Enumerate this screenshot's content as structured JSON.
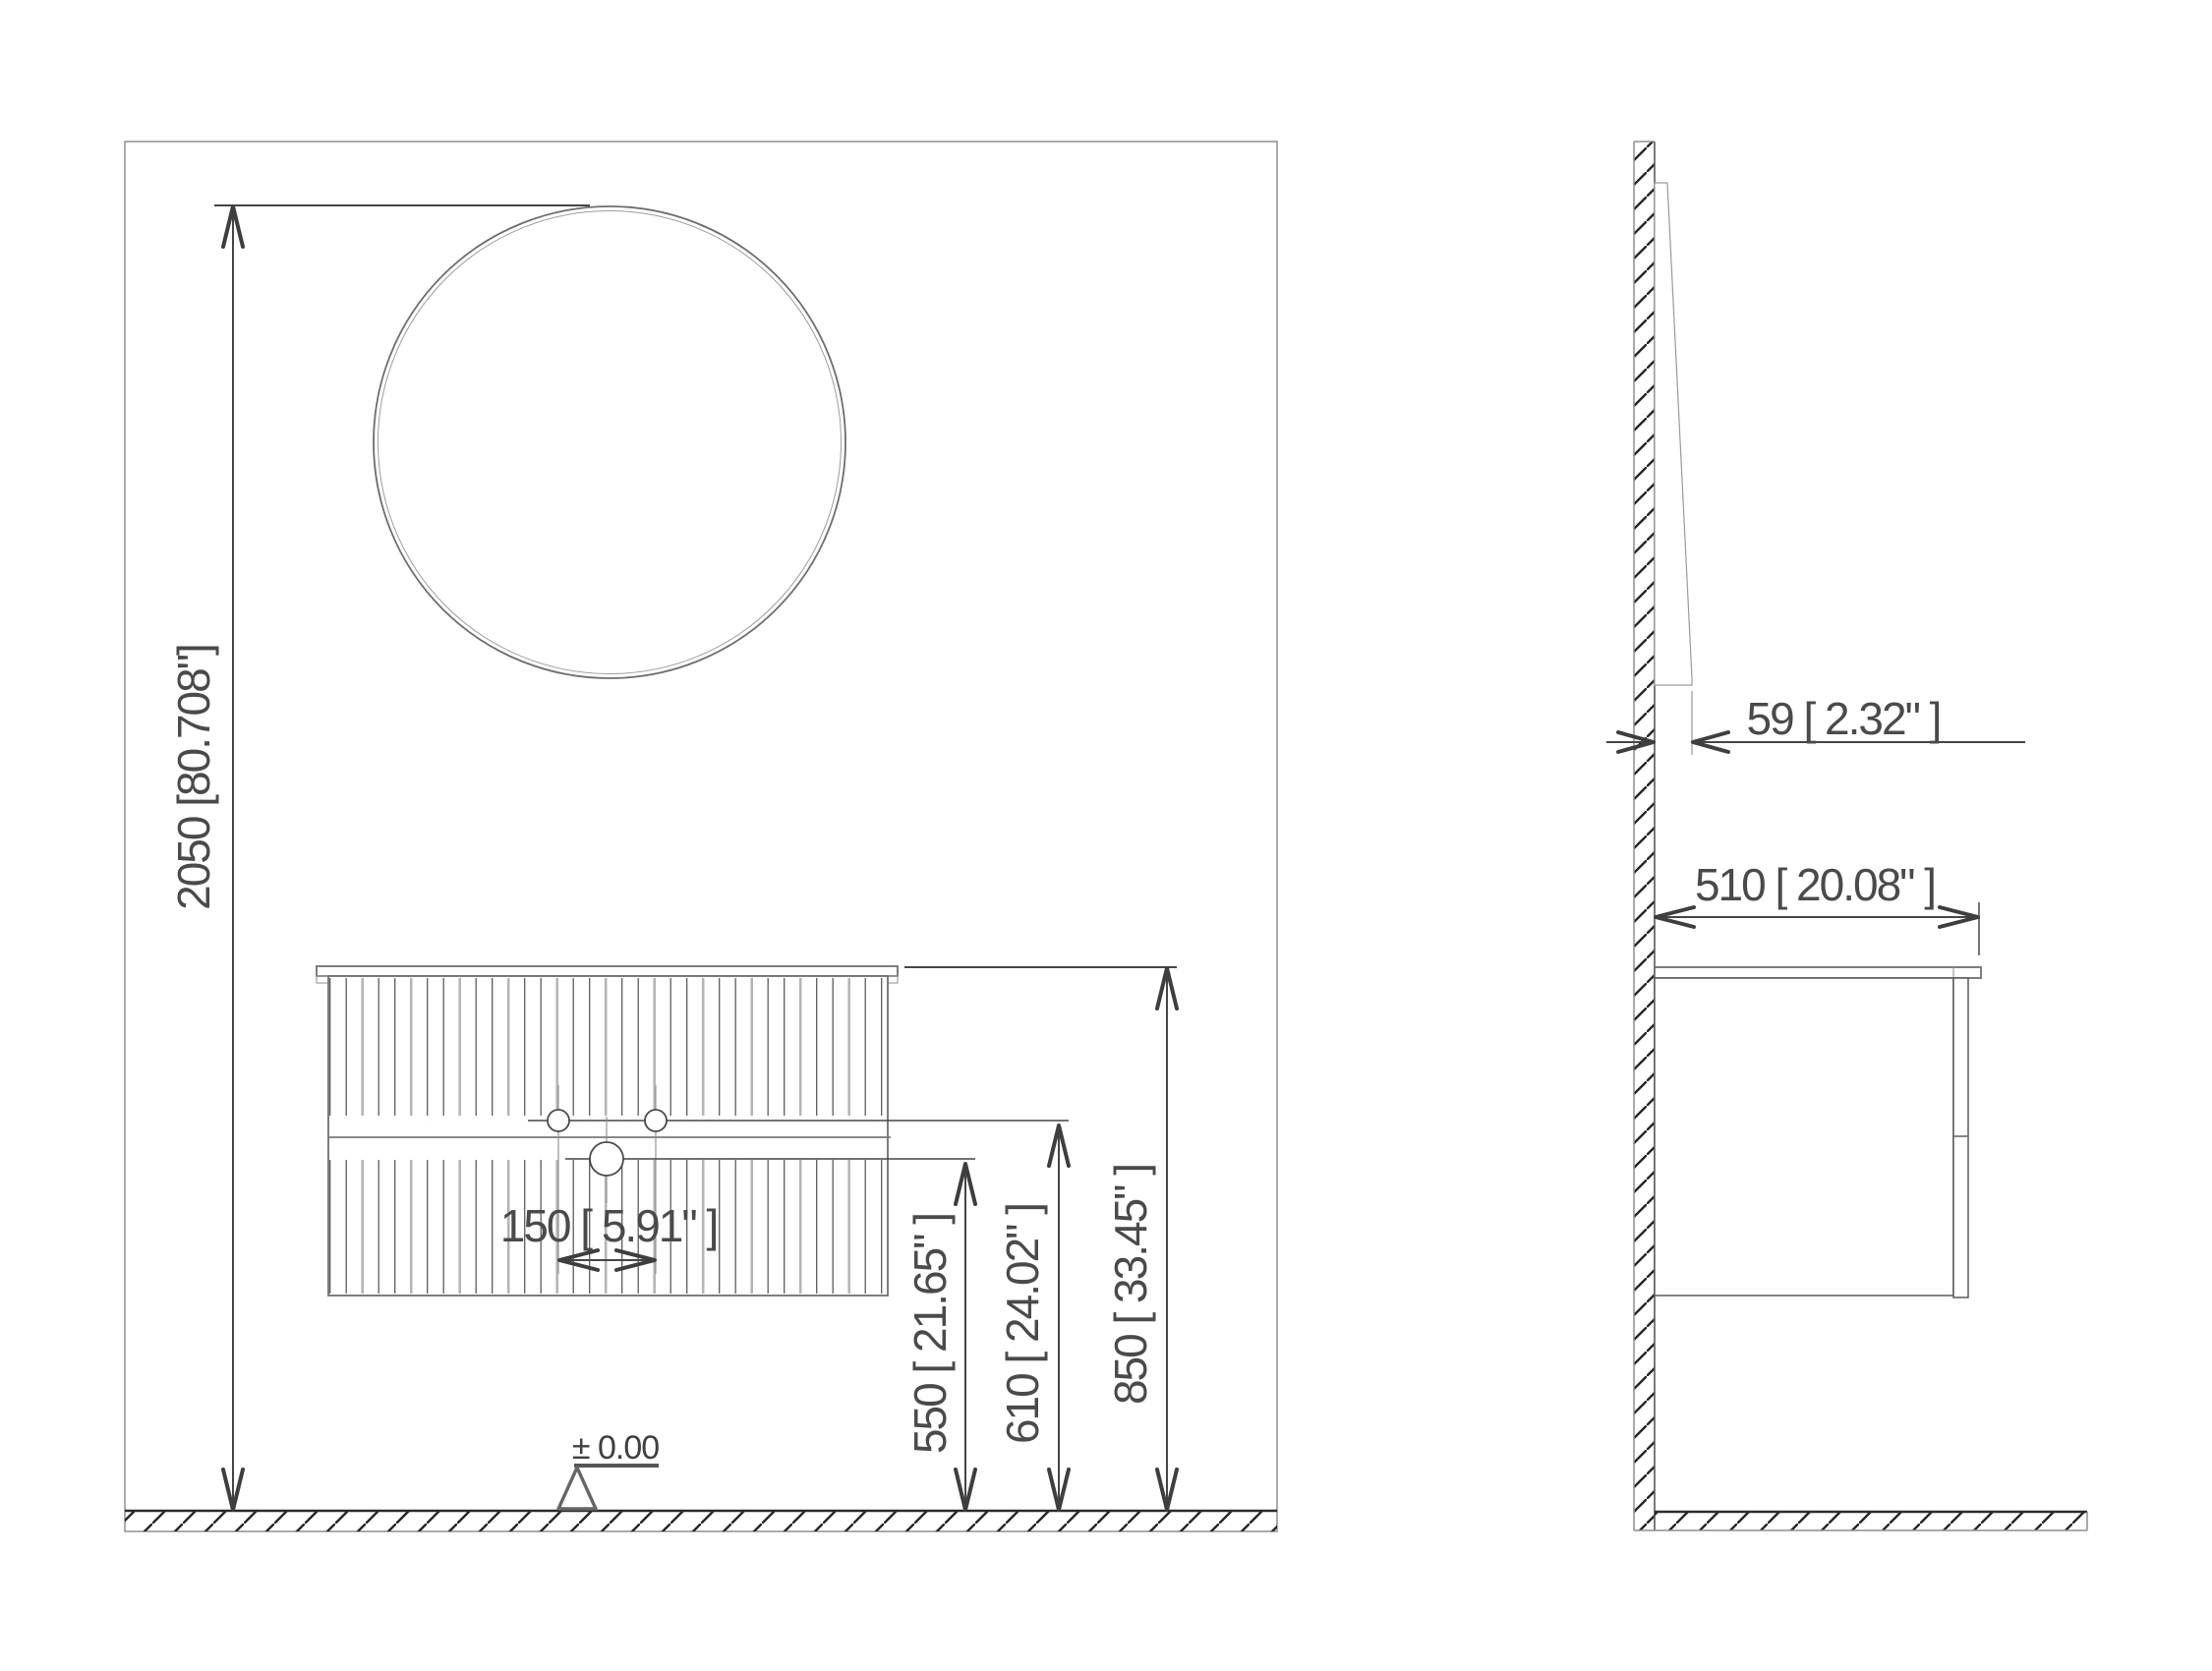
{
  "drawing": {
    "type": "bathroom vanity installation drawing",
    "views": {
      "front_label": "front elevation",
      "side_label": "side section"
    }
  },
  "front_view": {
    "dims": {
      "total_height": {
        "mm": 2050,
        "label": "2050 [80.708\"]"
      },
      "faucet_spacing": {
        "mm": 150,
        "label": "150 [ 5.91\" ]"
      },
      "drain_height": {
        "mm": 550,
        "label": "550 [ 21.65\" ]"
      },
      "outlet_height": {
        "mm": 610,
        "label": "610 [ 24.02\" ]"
      },
      "counter_height": {
        "mm": 850,
        "label": "850 [ 33.45\" ]"
      }
    },
    "datum": {
      "label": "± 0.00"
    }
  },
  "side_view": {
    "dims": {
      "mirror_depth": {
        "mm": 59,
        "label": "59 [ 2.32\" ]"
      },
      "cabinet_depth": {
        "mm": 510,
        "label": "510 [ 20.08\" ]"
      }
    }
  },
  "colors": {
    "line_dark": "#3e3e3e",
    "line_mid": "#6f6f6f",
    "line_light": "#979797",
    "text": "#4a4a4a",
    "background": "#ffffff"
  }
}
